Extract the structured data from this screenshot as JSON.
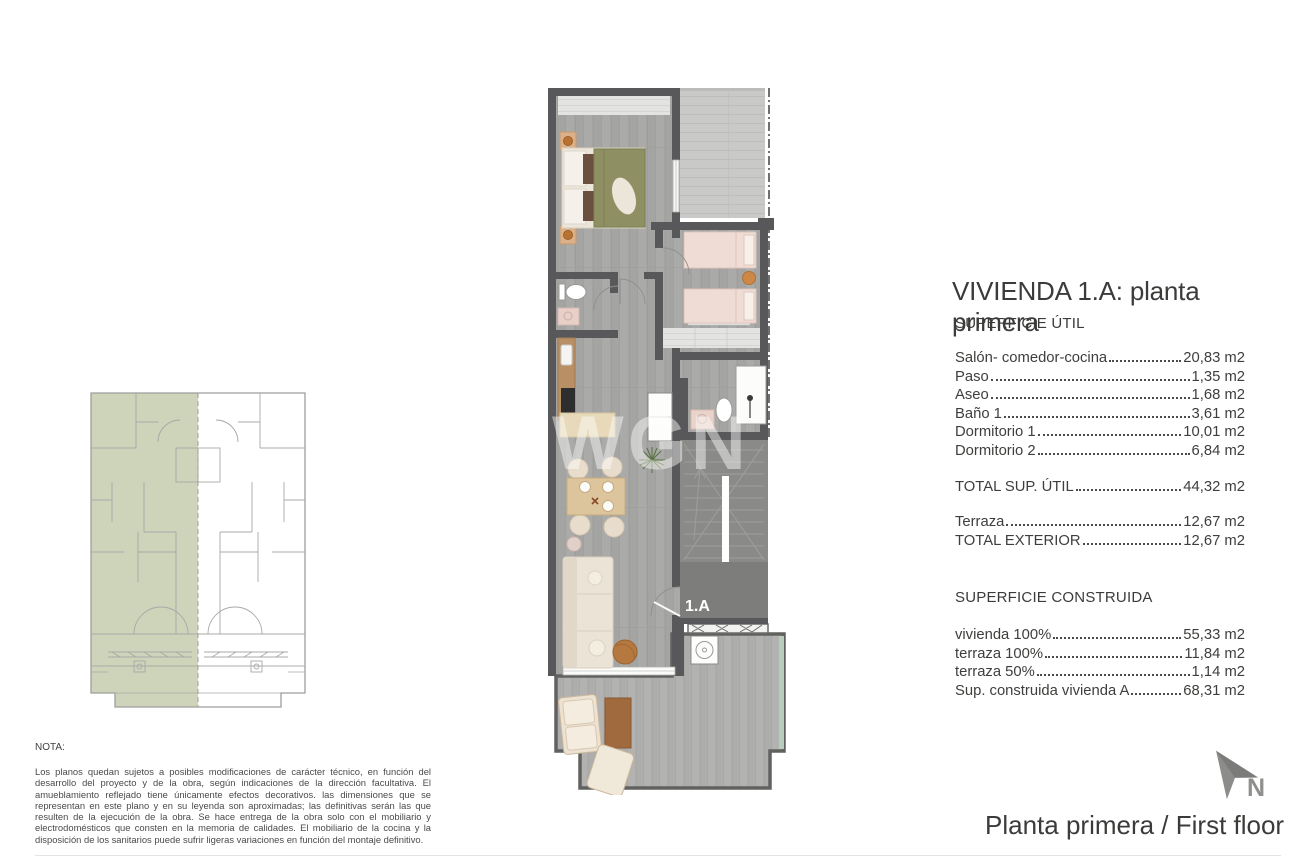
{
  "document": {
    "title": "VIVIENDA 1.A: planta primera",
    "bottom_title": "Planta primera / First floor",
    "watermark": "WGN",
    "north_label": "N",
    "unit_label": "1.A"
  },
  "superficie_util": {
    "heading": "SUPERFICIE ÚTIL",
    "rows": [
      {
        "label": "Salón- comedor-cocina",
        "value": "20,83 m2"
      },
      {
        "label": "Paso",
        "value": "1,35 m2"
      },
      {
        "label": "Aseo",
        "value": "1,68 m2"
      },
      {
        "label": "Baño 1",
        "value": "3,61 m2"
      },
      {
        "label": "Dormitorio 1",
        "value": "10,01 m2"
      },
      {
        "label": "Dormitorio 2",
        "value": "6,84 m2"
      }
    ],
    "total": {
      "label": "TOTAL SUP. ÚTIL",
      "value": "44,32 m2"
    },
    "exterior_rows": [
      {
        "label": "Terraza",
        "value": "12,67 m2"
      },
      {
        "label": "TOTAL EXTERIOR",
        "value": "12,67 m2"
      }
    ]
  },
  "superficie_construida": {
    "heading": "SUPERFICIE CONSTRUIDA",
    "rows": [
      {
        "label": "vivienda 100% ",
        "value": "55,33 m2"
      },
      {
        "label": "terraza 100%",
        "value": "11,84 m2"
      },
      {
        "label": "terraza 50%",
        "value": "1,14 m2"
      },
      {
        "label": "Sup. construida vivienda A",
        "value": "68,31 m2"
      }
    ]
  },
  "nota": {
    "heading": "NOTA:",
    "text": "Los planos quedan sujetos a posibles modificaciones de carácter técnico, en función del desarrollo del proyecto y de la obra, según indicaciones de la dirección facultativa. El amueblamiento reflejado tiene únicamente efectos decorativos. las dimensiones que se representan en este plano y en su leyenda son aproximadas; las definitivas serán las que resulten de la ejecución de la obra. Se hace entrega de la obra solo con el mobiliario y electrodomésticos que consten en la memoria de calidades. El mobiliario de la cocina y la disposición de los sanitarios puede sufrir ligeras variaciones en función del montaje definitivo."
  },
  "colors": {
    "wall": "#58585a",
    "floor": "#a4a4a2",
    "terrace_floor": "#c9c9c7",
    "stairs": "#8a8a88",
    "keyplan_highlight": "#cdd4b9",
    "bed_olive": "#8e9063",
    "bed_pink": "#efdcd4",
    "wood": "#b98f66",
    "text": "#3b3b3a"
  }
}
